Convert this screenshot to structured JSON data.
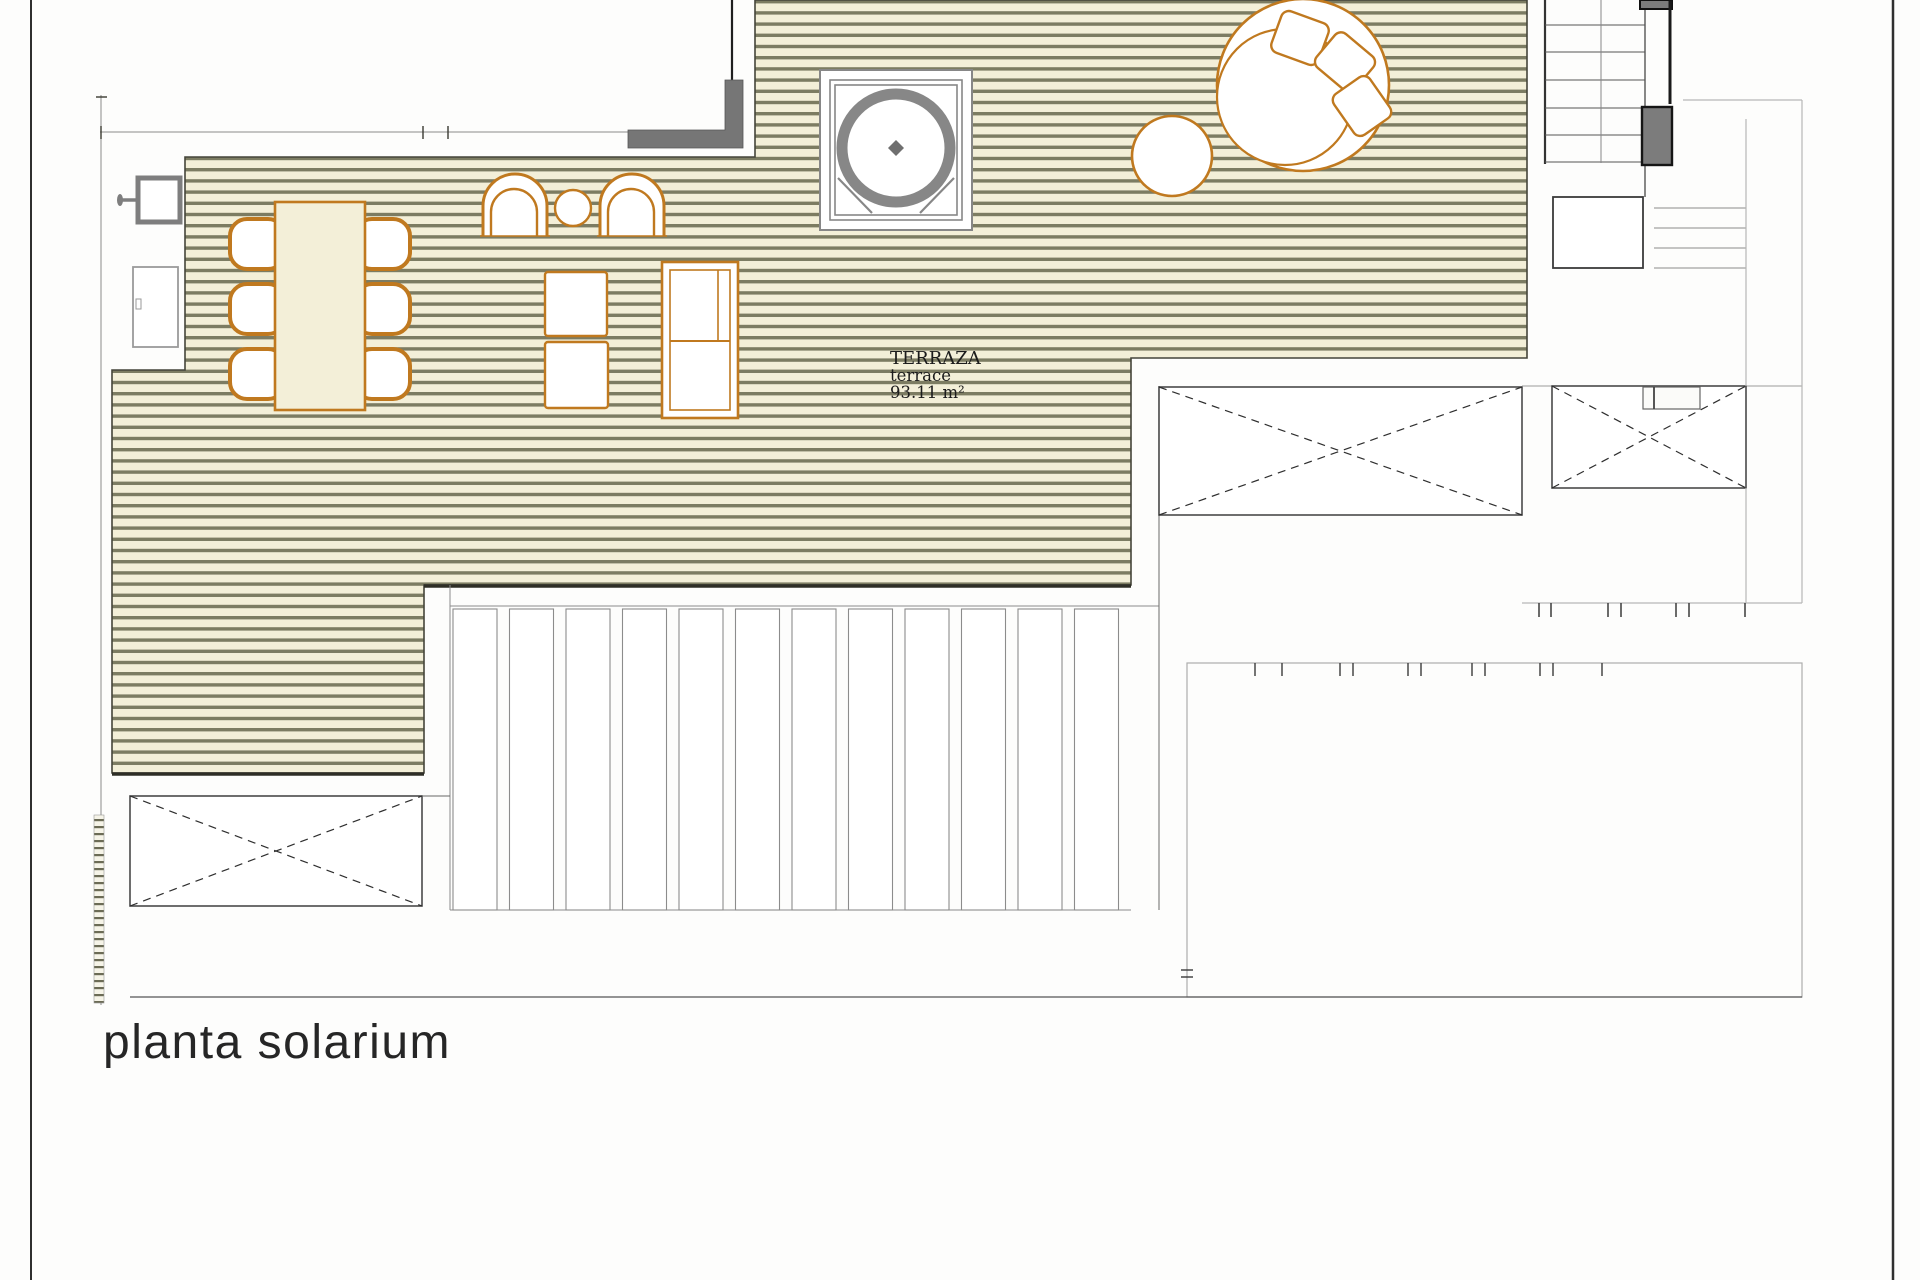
{
  "sheet": {
    "title": "planta solarium",
    "room": {
      "label": "TERRAZA",
      "label_en": "terrace",
      "area": "93.11 m²"
    }
  },
  "colors": {
    "deck_base": "#f3efd8",
    "deck_stripe": "#7c7c62",
    "furniture_accent": "#c0791f",
    "fixture_gray": "#878787",
    "wall_fill_gray": "#767676",
    "stair_fill_gray": "#7c7c7c",
    "line_dark": "#3a3a32",
    "line_light": "#b7b7b7"
  }
}
